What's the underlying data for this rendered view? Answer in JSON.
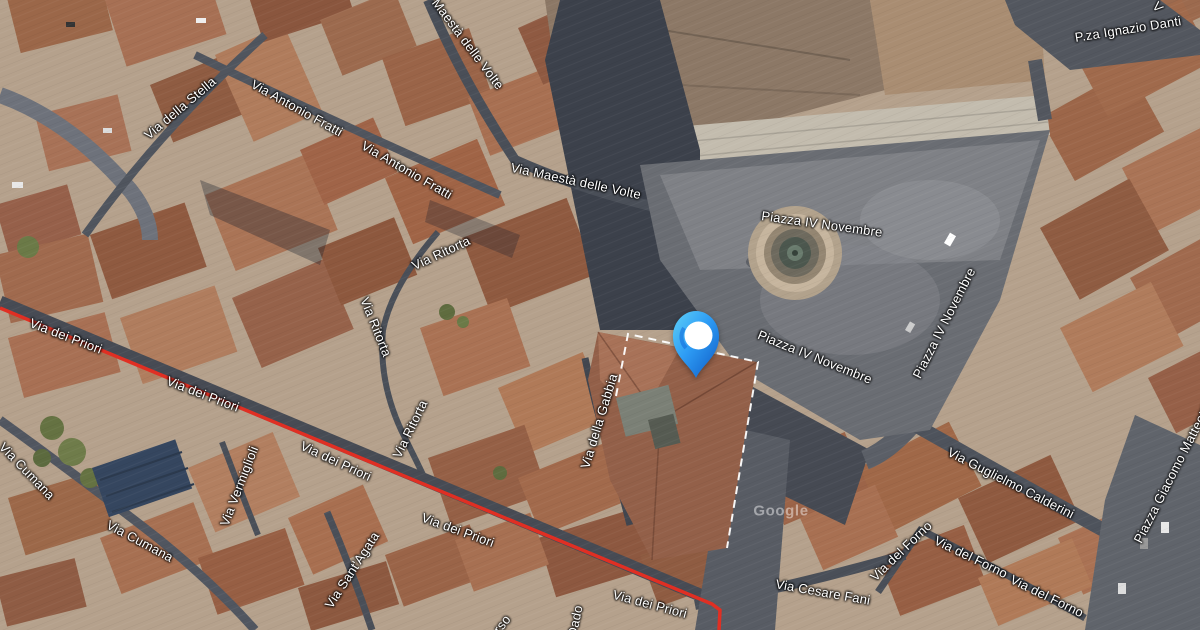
{
  "map": {
    "view_type": "satellite",
    "street_labels": [
      {
        "text": "Via della Stella",
        "x": 180,
        "y": 108,
        "rot": -40
      },
      {
        "text": "Via Antonio Fratti",
        "x": 297,
        "y": 108,
        "rot": 29
      },
      {
        "text": "Via Antonio Fratti",
        "x": 407,
        "y": 170,
        "rot": 30
      },
      {
        "text": "Maestà delle Volte",
        "x": 468,
        "y": 44,
        "rot": 53
      },
      {
        "text": "Via Maestà delle Volte",
        "x": 576,
        "y": 181,
        "rot": 12
      },
      {
        "text": "P.za Ignazio Danti",
        "x": 1128,
        "y": 29,
        "rot": -9
      },
      {
        "text": "V",
        "x": 1158,
        "y": 7,
        "rot": 48
      },
      {
        "text": "Piazza IV Novembre",
        "x": 822,
        "y": 224,
        "rot": 8
      },
      {
        "text": "Piazza IV Novembre",
        "x": 815,
        "y": 357,
        "rot": 22
      },
      {
        "text": "Piazza IV Novembre",
        "x": 944,
        "y": 323,
        "rot": -63
      },
      {
        "text": "Via Ritorta",
        "x": 441,
        "y": 253,
        "rot": -25
      },
      {
        "text": "Via Ritorta",
        "x": 376,
        "y": 327,
        "rot": 68
      },
      {
        "text": "Via Ritorta",
        "x": 410,
        "y": 429,
        "rot": -64
      },
      {
        "text": "Via dei Priori",
        "x": 66,
        "y": 336,
        "rot": 21
      },
      {
        "text": "Via dei Priori",
        "x": 203,
        "y": 394,
        "rot": 21
      },
      {
        "text": "Via dei Priori",
        "x": 336,
        "y": 461,
        "rot": 25
      },
      {
        "text": "Via dei Priori",
        "x": 458,
        "y": 530,
        "rot": 20
      },
      {
        "text": "Via dei Priori",
        "x": 650,
        "y": 604,
        "rot": 15
      },
      {
        "text": "Via Cumana",
        "x": 27,
        "y": 471,
        "rot": 46
      },
      {
        "text": "Via Cumana",
        "x": 140,
        "y": 541,
        "rot": 28
      },
      {
        "text": "Via Vermiglioli",
        "x": 239,
        "y": 486,
        "rot": -69
      },
      {
        "text": "Via Sant'Agata",
        "x": 352,
        "y": 570,
        "rot": -57
      },
      {
        "text": "Via della Gabbia",
        "x": 599,
        "y": 421,
        "rot": -73
      },
      {
        "text": "Via Guglielmo Calderini",
        "x": 1011,
        "y": 483,
        "rot": 27
      },
      {
        "text": "Piazza Giacomo Matteotti",
        "x": 1172,
        "y": 474,
        "rot": -63
      },
      {
        "text": "Via del Forno",
        "x": 901,
        "y": 551,
        "rot": -44
      },
      {
        "text": "Via del Forno",
        "x": 971,
        "y": 557,
        "rot": 26
      },
      {
        "text": "Via del Forno",
        "x": 1047,
        "y": 596,
        "rot": 26
      },
      {
        "text": "Via Cesare Fani",
        "x": 823,
        "y": 592,
        "rot": 10
      },
      {
        "text": "rso",
        "x": 502,
        "y": 624,
        "rot": -52
      },
      {
        "text": "Dado",
        "x": 575,
        "y": 621,
        "rot": -78
      },
      {
        "text": "Google",
        "x": 781,
        "y": 511,
        "rot": 0,
        "size": 15,
        "watermark": true
      }
    ],
    "marker": {
      "x": 696,
      "y": 384,
      "color_top": "#5fd0f7",
      "color_mid": "#2e9df5",
      "color_bottom": "#0e59c4",
      "hole_color": "#ffffff"
    },
    "route": {
      "color": "#e02f23",
      "points": [
        [
          0,
          308
        ],
        [
          712,
          604
        ],
        [
          720,
          610
        ],
        [
          719,
          630
        ]
      ]
    },
    "building_outline": {
      "color": "#ffffff",
      "dash": "8 6"
    }
  }
}
